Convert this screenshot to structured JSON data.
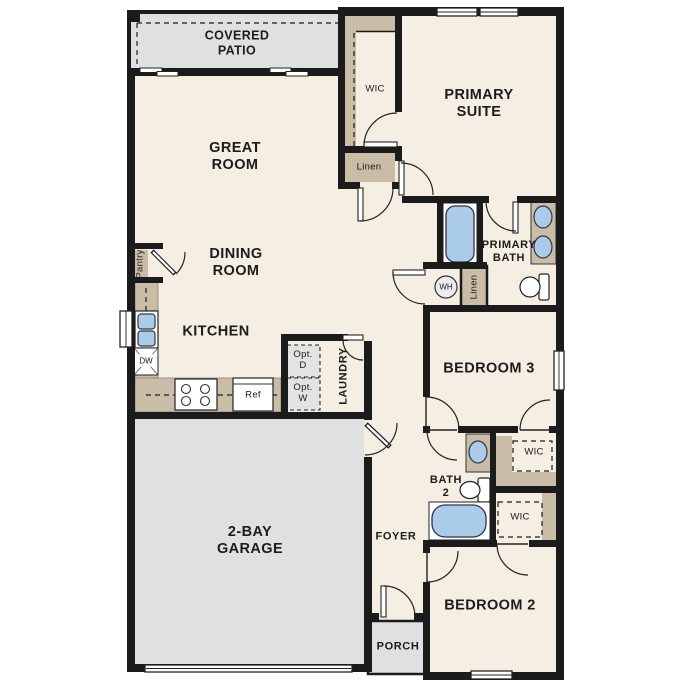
{
  "colors": {
    "floor_cream": "#f5eee2",
    "concrete_gray": "#e0e0e0",
    "closet_tan": "#c9bda7",
    "wall_black": "#1b1b1b",
    "fixture_blue": "#abcbea",
    "appliance_gray": "#e3e3e3"
  },
  "rooms": {
    "covered_patio": "COVERED\nPATIO",
    "great_room": "GREAT\nROOM",
    "dining_room": "DINING\nROOM",
    "kitchen": "KITCHEN",
    "pantry": "Pantry",
    "laundry": "LAUNDRY",
    "wic_top": "WIC",
    "linen_top": "Linen",
    "primary_suite": "PRIMARY\nSUITE",
    "primary_bath": "PRIMARY\nBATH",
    "linen_hall": "Linen",
    "bedroom3": "BEDROOM 3",
    "wic_bedroom3": "WIC",
    "bath2": "BATH\n2",
    "wic_bedroom2": "WIC",
    "bedroom2": "BEDROOM 2",
    "foyer": "FOYER",
    "porch": "PORCH",
    "garage": "2-BAY\nGARAGE"
  },
  "fixtures": {
    "water_heater": "WH",
    "dishwasher": "DW",
    "refrigerator": "Ref",
    "optional_dryer": "Opt.\nD",
    "optional_washer": "Opt.\nW"
  }
}
